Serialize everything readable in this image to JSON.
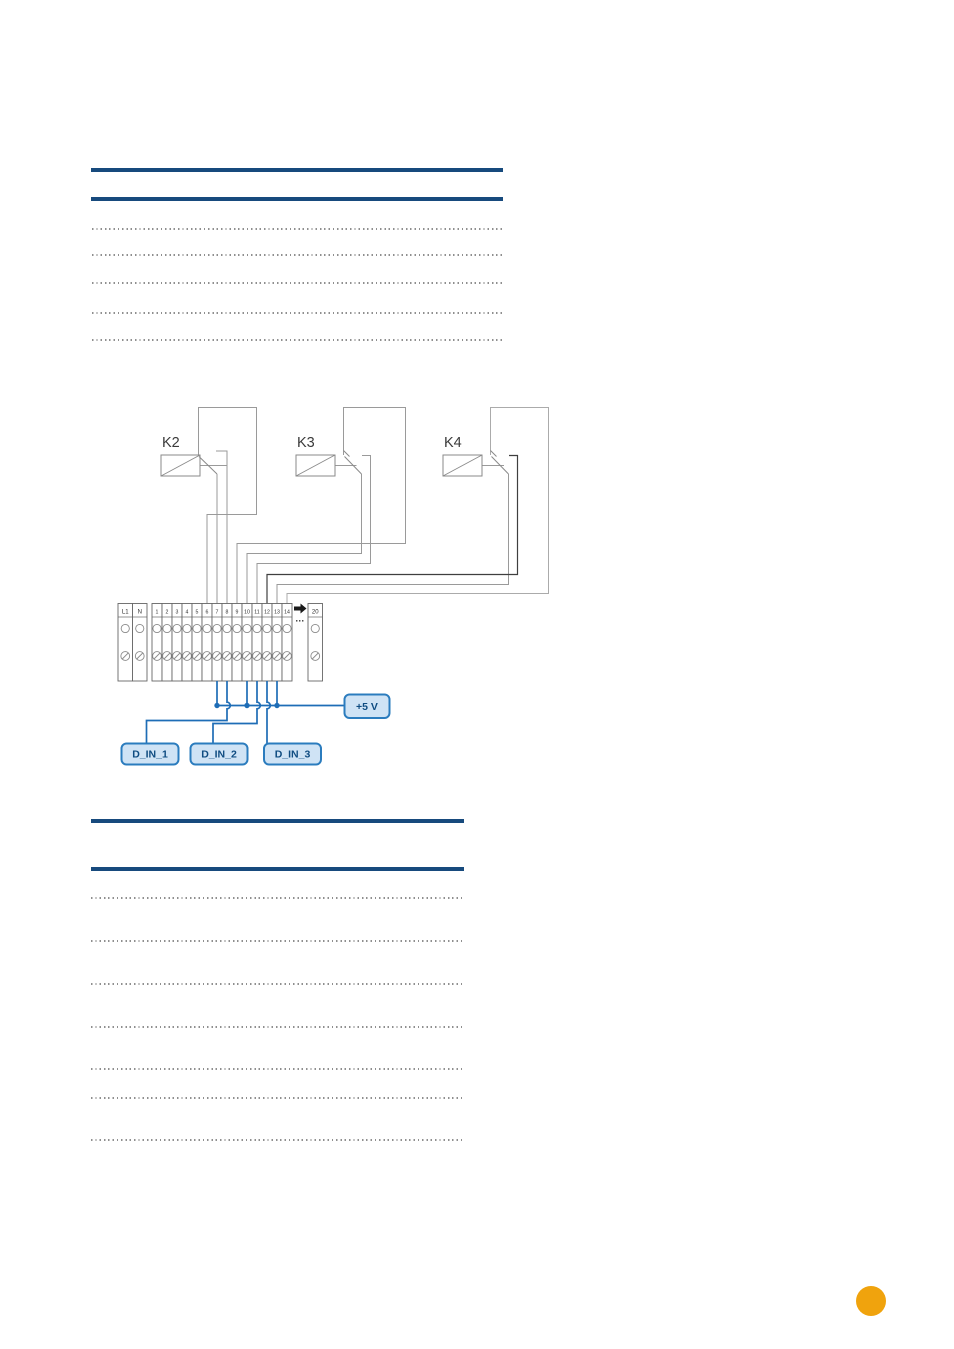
{
  "colors": {
    "rule_blue": "#174a7d",
    "leader_gray": "#8f8f8f",
    "wire_gray": "#9a9a9a",
    "wire_gray_light": "#ababab",
    "wire_dark": "#3f3f3f",
    "relay_stroke": "#8a8a8a",
    "relay_label": "#3a3a3a",
    "terminal_stroke": "#666666",
    "terminal_symbol": "#8a8a8a",
    "terminal_text": "#2f2f2f",
    "arrow_black": "#1a1a1a",
    "blue_wire": "#1e6db6",
    "label_box_fill": "#cfe3f5",
    "label_box_border": "#2b7cbe",
    "label_text": "#0f4c81",
    "page_marker_orange": "#f0a30d"
  },
  "diagram": {
    "relays": [
      {
        "label": "K2"
      },
      {
        "label": "K3"
      },
      {
        "label": "K4"
      }
    ],
    "terminal_strip": {
      "left_block_labels": [
        "L1",
        "N"
      ],
      "main_block_labels": [
        "1",
        "2",
        "3",
        "4",
        "5",
        "6",
        "7",
        "8",
        "9",
        "10",
        "11",
        "12",
        "13",
        "14"
      ],
      "gap_ellipsis": "...",
      "right_block_labels": [
        "20"
      ]
    },
    "labels": {
      "supply": "+5 V",
      "input1": "D_IN_1",
      "input2": "D_IN_2",
      "input3": "D_IN_3"
    }
  }
}
